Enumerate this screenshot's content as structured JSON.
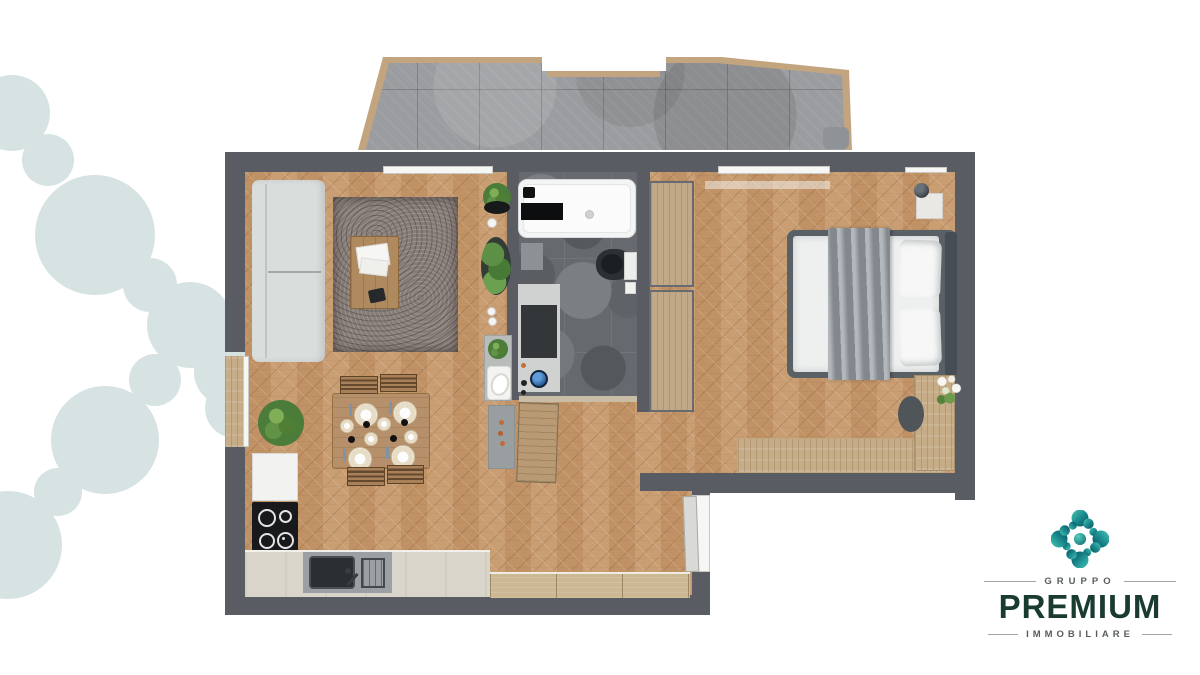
{
  "scene": {
    "type": "apartment-floor-plan-render",
    "background": "#ffffff",
    "rooms": [
      "terrace",
      "living-room",
      "dining-area",
      "kitchen",
      "bathroom",
      "hallway",
      "bedroom"
    ]
  },
  "decor": {
    "blob_color": "#d6e3e2"
  },
  "palette": {
    "wall": "#595c62",
    "parquet": "#c89c72",
    "terrace_tile": "#9b9c9f",
    "terrace_border": "#c2a57f",
    "bathroom_tile": "#66696e",
    "light_wood": "#c6ad88",
    "counter_stone": "#d9d5ca"
  },
  "brand": {
    "group_label": "GRUPPO",
    "name": "PREMIUM",
    "sector_label": "IMMOBILIARE",
    "mark_teal_light": "#49c6b4",
    "mark_teal_dark": "#0b4b55",
    "wordmark_color": "#1a3b31",
    "label_color": "#585d5e"
  }
}
